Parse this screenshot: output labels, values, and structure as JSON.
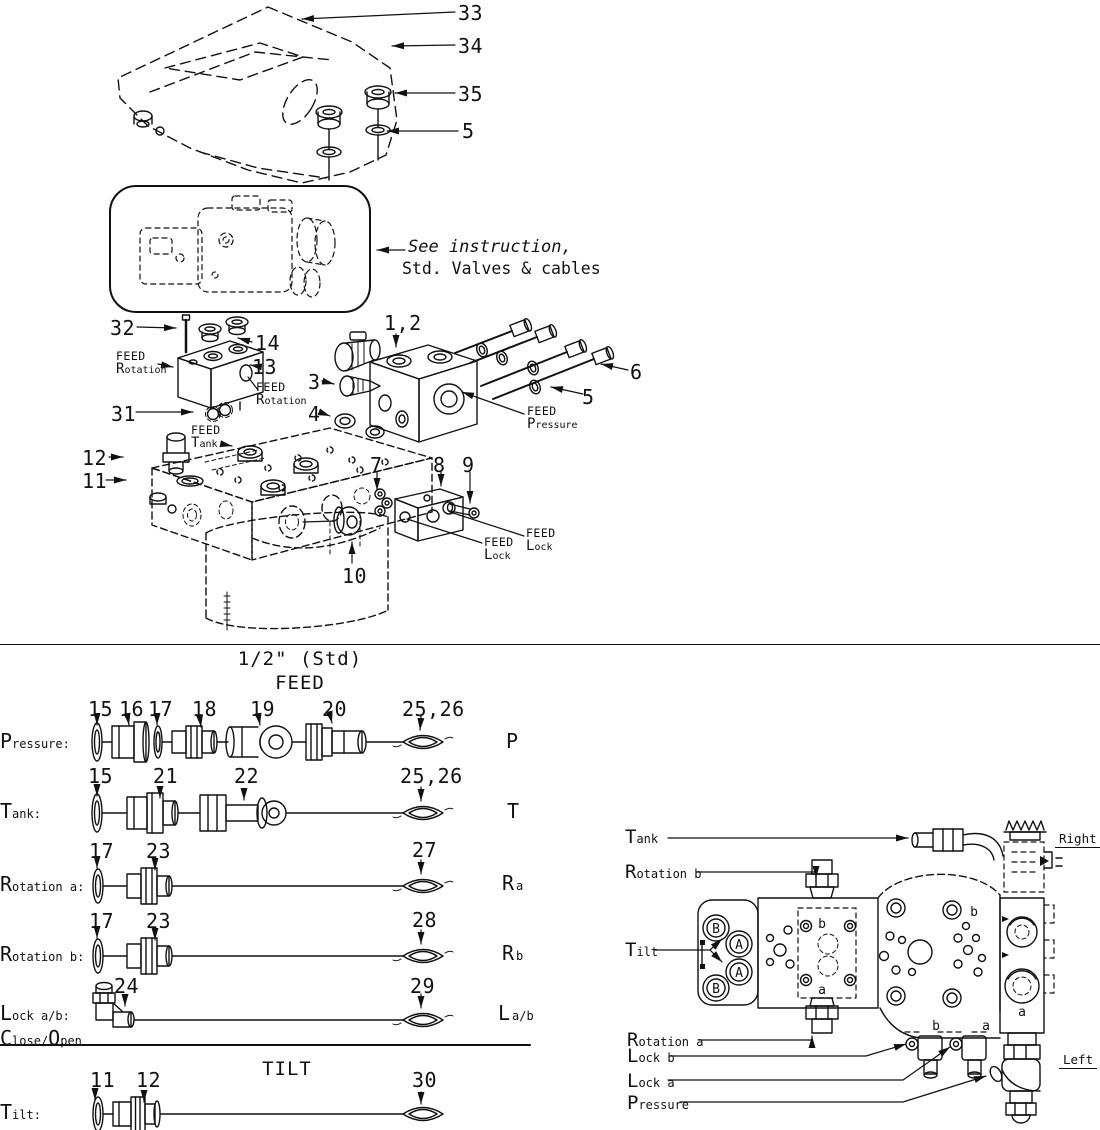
{
  "top": {
    "callouts": {
      "n33": "33",
      "n34": "34",
      "n35": "35",
      "n5_top": "5",
      "n32": "32",
      "n14": "14",
      "n13": "13",
      "n31": "31",
      "n12": "12",
      "n11": "11",
      "n1_2": "1,2",
      "n3": "3",
      "n4": "4",
      "n6": "6",
      "n5_mid": "5",
      "n7": "7",
      "n8": "8",
      "n9": "9",
      "n10": "10"
    },
    "instruction": {
      "line1": "See instruction,",
      "line2": "Std. Valves & cables"
    },
    "feed_labels": {
      "rotation_left": {
        "line1": "FEED",
        "line2": "Rotation"
      },
      "rotation_right": {
        "line1": "FEED",
        "line2": "Rotation"
      },
      "tank": {
        "line1": "FEED",
        "line2": "Tank"
      },
      "pressure": {
        "line1": "FEED",
        "line2": "Pressure"
      },
      "lock_left": {
        "line1": "FEED",
        "line2": "Lock"
      },
      "lock_right": {
        "line1": "FEED",
        "line2": "Lock"
      }
    }
  },
  "fittings": {
    "headers": {
      "size": "1/2\" (Std)",
      "feed": "FEED",
      "tilt": "TILT"
    },
    "rows": {
      "pressure": {
        "label": "Pressure:",
        "port": "P",
        "n15": "15",
        "n16": "16",
        "n17": "17",
        "n18": "18",
        "n19": "19",
        "n20": "20",
        "n25_26": "25,26"
      },
      "tank": {
        "label": "Tank:",
        "port": "T",
        "n15": "15",
        "n21": "21",
        "n22": "22",
        "n25_26": "25,26"
      },
      "rotation_a": {
        "label": "Rotation a:",
        "port_main": "R",
        "port_sub": "a",
        "n17": "17",
        "n23": "23",
        "n27": "27"
      },
      "rotation_b": {
        "label": "Rotation b:",
        "port_main": "R",
        "port_sub": "b",
        "n17": "17",
        "n23": "23",
        "n28": "28"
      },
      "lock": {
        "label": "Lock a/b:",
        "label2a": "Close/",
        "label2b": "Open",
        "port_main": "L",
        "port_sub": "a/b",
        "n24": "24",
        "n29": "29"
      },
      "tilt": {
        "label": "Tilt:",
        "n11": "11",
        "n12": "12",
        "n30": "30"
      }
    }
  },
  "assembled": {
    "labels": {
      "tank": "Tank",
      "rotation_b": "Rotation b",
      "tilt": "Tilt",
      "rotation_a": "Rotation a",
      "lock_b": "Lock b",
      "lock_a": "Lock a",
      "pressure": "Pressure"
    },
    "orientation": {
      "right": "Right",
      "left": "Left"
    },
    "ports": {
      "circled_1": "B",
      "circled_2": "A",
      "circled_3": "A",
      "circled_4": "B",
      "plate_top": "b",
      "plate_bottom": "a",
      "mid_top": "b",
      "bottom_b": "b",
      "bottom_a": "a",
      "right_a": "a"
    }
  }
}
